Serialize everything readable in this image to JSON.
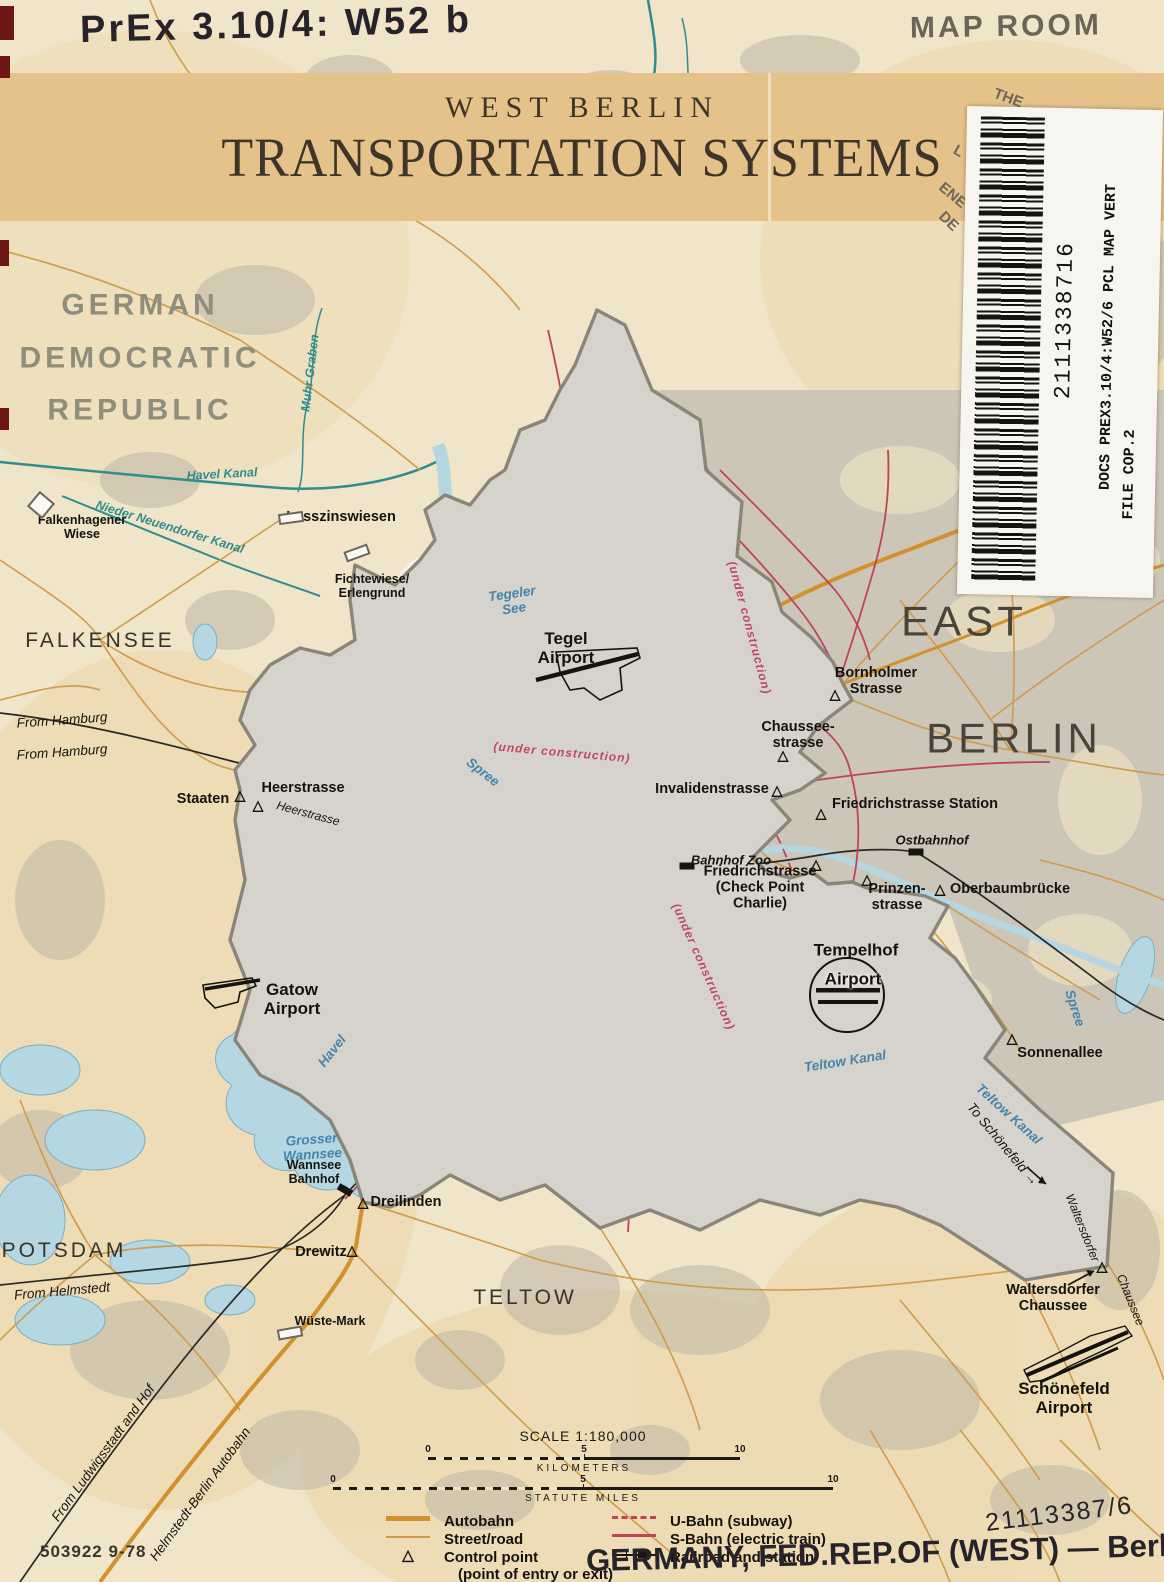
{
  "annotations": {
    "call_number_handwritten": "PrEx 3.10/4: W52 b",
    "map_room_stamp": "MAP ROOM",
    "catalog_handwritten": "21113387/6",
    "subject_handwritten": "GERMANY, FED.REP.OF (WEST) — Berlin, West",
    "print_code": "503922 9-78"
  },
  "title": {
    "line1": "WEST BERLIN",
    "line2": "TRANSPORTATION SYSTEMS"
  },
  "sticker": {
    "barcode_number": "2111338716",
    "line1": "DOCS PREX3.10/4:W52/6  PCL MAP VERT",
    "line2": "FILE COP.2"
  },
  "scale": {
    "title": "SCALE 1:180,000",
    "km_label": "KILOMETERS",
    "miles_label": "STATUTE MILES",
    "ticks": [
      "0",
      "5",
      "10"
    ]
  },
  "legend": {
    "left": [
      {
        "label": "Autobahn"
      },
      {
        "label": "Street/road"
      },
      {
        "label": "Control point",
        "sub": "(point of entry or exit)"
      }
    ],
    "right": [
      {
        "label": "U-Bahn (subway)"
      },
      {
        "label": "S-Bahn (electric train)"
      },
      {
        "label": "Railroad and station"
      }
    ]
  },
  "colors": {
    "paper": "#f0e5c9",
    "banner": "#e5c28a",
    "water": "#b4d7e2",
    "canal": "#2f8d8d",
    "autobahn": "#d2912c",
    "street": "#cf9b4c",
    "sbahn_ubahn": "#c24258",
    "railroad": "#2a2825",
    "boundary": "#8a8579",
    "east_builtup": "#ccc6b9"
  },
  "map": {
    "marker_glyphs": {
      "tri": "△"
    },
    "labels": [
      {
        "t": "GERMAN\nDEMOCRATIC\nREPUBLIC",
        "x": 140,
        "y": 358,
        "c": "region",
        "n": "label-german-democratic-republic"
      },
      {
        "t": "FALKENSEE",
        "x": 100,
        "y": 641,
        "c": "town",
        "n": "label-falkensee"
      },
      {
        "t": "EAST",
        "x": 964,
        "y": 621,
        "c": "city",
        "n": "label-east-berlin-1"
      },
      {
        "t": "BERLIN",
        "x": 1014,
        "y": 738,
        "c": "city",
        "n": "label-east-berlin-2"
      },
      {
        "t": "POTSDAM",
        "x": 64,
        "y": 1251,
        "c": "town",
        "n": "label-potsdam"
      },
      {
        "t": "TELTOW",
        "x": 525,
        "y": 1298,
        "c": "town",
        "n": "label-teltow"
      },
      {
        "t": "Havel Kanal",
        "x": 222,
        "y": 474,
        "c": "canal",
        "r": -3
      },
      {
        "t": "Nieder Neuendorfer Kanal",
        "x": 170,
        "y": 527,
        "c": "canal",
        "r": 17
      },
      {
        "t": "Muhr Graben",
        "x": 310,
        "y": 373,
        "c": "canal",
        "r": -83
      },
      {
        "t": "Tegeler\nSee",
        "x": 513,
        "y": 601,
        "c": "water",
        "r": -8
      },
      {
        "t": "Spree",
        "x": 483,
        "y": 772,
        "c": "water",
        "r": 38
      },
      {
        "t": "Havel",
        "x": 332,
        "y": 1051,
        "c": "water",
        "r": -52
      },
      {
        "t": "Grosser\nWannsee",
        "x": 312,
        "y": 1147,
        "c": "water",
        "r": -4
      },
      {
        "t": "Teltow  Kanal",
        "x": 845,
        "y": 1061,
        "c": "water",
        "r": -9
      },
      {
        "t": "Teltow Kanal",
        "x": 1009,
        "y": 1114,
        "c": "water",
        "r": 42
      },
      {
        "t": "Spree",
        "x": 1075,
        "y": 1008,
        "c": "water",
        "r": 72
      },
      {
        "t": "Lasszinswiesen",
        "x": 341,
        "y": 517,
        "c": "place"
      },
      {
        "t": "Falkenhagener\nWiese",
        "x": 82,
        "y": 527,
        "c": "place-sm"
      },
      {
        "t": "Fichtewiese/\nErlengrund",
        "x": 372,
        "y": 586,
        "c": "place-sm"
      },
      {
        "t": "Tegel\nAirport",
        "x": 566,
        "y": 648,
        "c": "place-lg",
        "n": "label-tegel-airport"
      },
      {
        "t": "Bornholmer\nStrasse",
        "x": 876,
        "y": 681,
        "c": "place",
        "n": "label-bornholmer-strasse"
      },
      {
        "t": "Chaussee-\nstrasse",
        "x": 798,
        "y": 735,
        "c": "place",
        "n": "label-chausseestrasse"
      },
      {
        "t": "Invalidenstrasse",
        "x": 712,
        "y": 789,
        "c": "place",
        "n": "label-invalidenstrasse"
      },
      {
        "t": "Friedrichstrasse Station",
        "x": 915,
        "y": 804,
        "c": "place",
        "n": "label-friedrichstrasse-station"
      },
      {
        "t": "Bahnhof Zoo",
        "x": 731,
        "y": 861,
        "c": "place-it",
        "n": "label-bahnhof-zoo"
      },
      {
        "t": "Friedrichstrasse\n(Check Point\nCharlie)",
        "x": 760,
        "y": 888,
        "c": "place",
        "n": "label-checkpoint-charlie"
      },
      {
        "t": "Prinzen-\nstrasse",
        "x": 897,
        "y": 897,
        "c": "place",
        "n": "label-prinzenstrasse"
      },
      {
        "t": "Oberbaumbrücke",
        "x": 1010,
        "y": 889,
        "c": "place",
        "n": "label-oberbaumbruecke"
      },
      {
        "t": "Ostbahnhof",
        "x": 932,
        "y": 841,
        "c": "place-it",
        "n": "label-ostbahnhof"
      },
      {
        "t": "Tempelhof",
        "x": 856,
        "y": 950,
        "c": "place-lg",
        "n": "label-tempelhof"
      },
      {
        "t": "Airport",
        "x": 853,
        "y": 979,
        "c": "place-lg halo",
        "n": "label-tempelhof-airport"
      },
      {
        "t": "Sonnenallee",
        "x": 1060,
        "y": 1053,
        "c": "place",
        "n": "label-sonnenallee"
      },
      {
        "t": "Gatow\nAirport",
        "x": 292,
        "y": 999,
        "c": "place-lg",
        "n": "label-gatow-airport"
      },
      {
        "t": "Heerstrasse",
        "x": 303,
        "y": 788,
        "c": "place",
        "n": "label-heerstrasse"
      },
      {
        "t": "Staaten",
        "x": 203,
        "y": 799,
        "c": "place",
        "n": "label-staaten"
      },
      {
        "t": "Heerstrasse",
        "x": 308,
        "y": 814,
        "c": "roadlbl",
        "r": 15
      },
      {
        "t": "Wannsee\nBahnhof",
        "x": 314,
        "y": 1172,
        "c": "place-sm",
        "n": "label-wannsee-bahnhof"
      },
      {
        "t": "Dreilinden",
        "x": 406,
        "y": 1202,
        "c": "place",
        "n": "label-dreilinden"
      },
      {
        "t": "Drewitz",
        "x": 321,
        "y": 1252,
        "c": "place",
        "n": "label-drewitz"
      },
      {
        "t": "Wüste-Mark",
        "x": 330,
        "y": 1321,
        "c": "place-sm",
        "n": "label-wueste-mark"
      },
      {
        "t": "Waltersdorfer\nChaussee",
        "x": 1053,
        "y": 1298,
        "c": "place",
        "n": "label-waltersdorfer-chaussee"
      },
      {
        "t": "Schönefeld\nAirport",
        "x": 1064,
        "y": 1398,
        "c": "place-lg",
        "n": "label-schoenefeld-airport"
      },
      {
        "t": "To  Schönefeld  →",
        "x": 1003,
        "y": 1144,
        "c": "rail",
        "r": 50
      },
      {
        "t": "Waltersdorfer",
        "x": 1082,
        "y": 1228,
        "c": "roadlbl",
        "r": 68
      },
      {
        "t": "Chaussee",
        "x": 1130,
        "y": 1300,
        "c": "roadlbl",
        "r": 68
      },
      {
        "t": "From Hamburg",
        "x": 62,
        "y": 720,
        "c": "rail",
        "r": -4
      },
      {
        "t": "From Hamburg",
        "x": 62,
        "y": 752,
        "c": "rail",
        "r": -4
      },
      {
        "t": "From  Helmstedt",
        "x": 62,
        "y": 1291,
        "c": "rail",
        "r": -5
      },
      {
        "t": "From Ludwigsstadt and Hof",
        "x": 103,
        "y": 1453,
        "c": "rail",
        "r": -54
      },
      {
        "t": "Helmstedt-Berlin Autobahn",
        "x": 200,
        "y": 1494,
        "c": "rail",
        "r": -54
      },
      {
        "t": "(under construction)",
        "x": 749,
        "y": 628,
        "c": "constr",
        "r": 75
      },
      {
        "t": "(under    construction)",
        "x": 562,
        "y": 753,
        "c": "constr",
        "r": 5
      },
      {
        "t": "(under construction)",
        "x": 703,
        "y": 967,
        "c": "constr",
        "r": 66
      },
      {
        "t": "THE",
        "x": 1008,
        "y": 99,
        "c": "stampfrag",
        "r": 20
      },
      {
        "t": "OF",
        "x": 976,
        "y": 121,
        "c": "stampfrag",
        "r": 28
      },
      {
        "t": "L",
        "x": 958,
        "y": 152,
        "c": "stampfrag",
        "r": 30
      },
      {
        "t": "ENE",
        "x": 952,
        "y": 196,
        "c": "stampfrag",
        "r": 40
      },
      {
        "t": "DE",
        "x": 948,
        "y": 222,
        "c": "stampfrag",
        "r": 44
      }
    ],
    "markers": [
      {
        "k": "tri",
        "x": 240,
        "y": 795,
        "n": "control-point-staaten"
      },
      {
        "k": "tri",
        "x": 258,
        "y": 805,
        "n": "control-point-heerstrasse"
      },
      {
        "k": "tri",
        "x": 835,
        "y": 694,
        "n": "control-point-bornholmer"
      },
      {
        "k": "tri",
        "x": 783,
        "y": 755,
        "n": "control-point-chausseestrasse"
      },
      {
        "k": "tri",
        "x": 777,
        "y": 790,
        "n": "control-point-invalidenstrasse"
      },
      {
        "k": "tri",
        "x": 821,
        "y": 813,
        "n": "control-point-friedrichstrasse-station"
      },
      {
        "k": "tri",
        "x": 816,
        "y": 864,
        "n": "control-point-checkpoint-charlie"
      },
      {
        "k": "tri",
        "x": 867,
        "y": 879,
        "n": "control-point-prinzenstrasse"
      },
      {
        "k": "tri",
        "x": 940,
        "y": 889,
        "n": "control-point-oberbaumbruecke"
      },
      {
        "k": "tri",
        "x": 1012,
        "y": 1038,
        "n": "control-point-sonnenallee"
      },
      {
        "k": "tri",
        "x": 363,
        "y": 1202,
        "n": "control-point-dreilinden"
      },
      {
        "k": "tri",
        "x": 352,
        "y": 1250,
        "n": "control-point-drewitz"
      },
      {
        "k": "tri",
        "x": 1102,
        "y": 1266,
        "n": "control-point-waltersdorfer"
      },
      {
        "k": "sta",
        "x": 687,
        "y": 866,
        "n": "station-bahnhof-zoo"
      },
      {
        "k": "sta",
        "x": 916,
        "y": 852,
        "n": "station-ostbahnhof"
      },
      {
        "k": "sta",
        "x": 345,
        "y": 1190,
        "r": 30,
        "n": "station-wannsee"
      },
      {
        "k": "wrect",
        "x": 291,
        "y": 518,
        "r": -8,
        "n": "site-lasszinswiesen"
      },
      {
        "k": "wrect",
        "x": 290,
        "y": 1333,
        "r": -10,
        "n": "site-wueste-mark"
      },
      {
        "k": "wrect",
        "x": 357,
        "y": 553,
        "r": -20,
        "n": "site-fichtewiese"
      },
      {
        "k": "wdia",
        "x": 41,
        "y": 505,
        "r": 40,
        "n": "site-falkenhagener-wiese"
      }
    ]
  }
}
